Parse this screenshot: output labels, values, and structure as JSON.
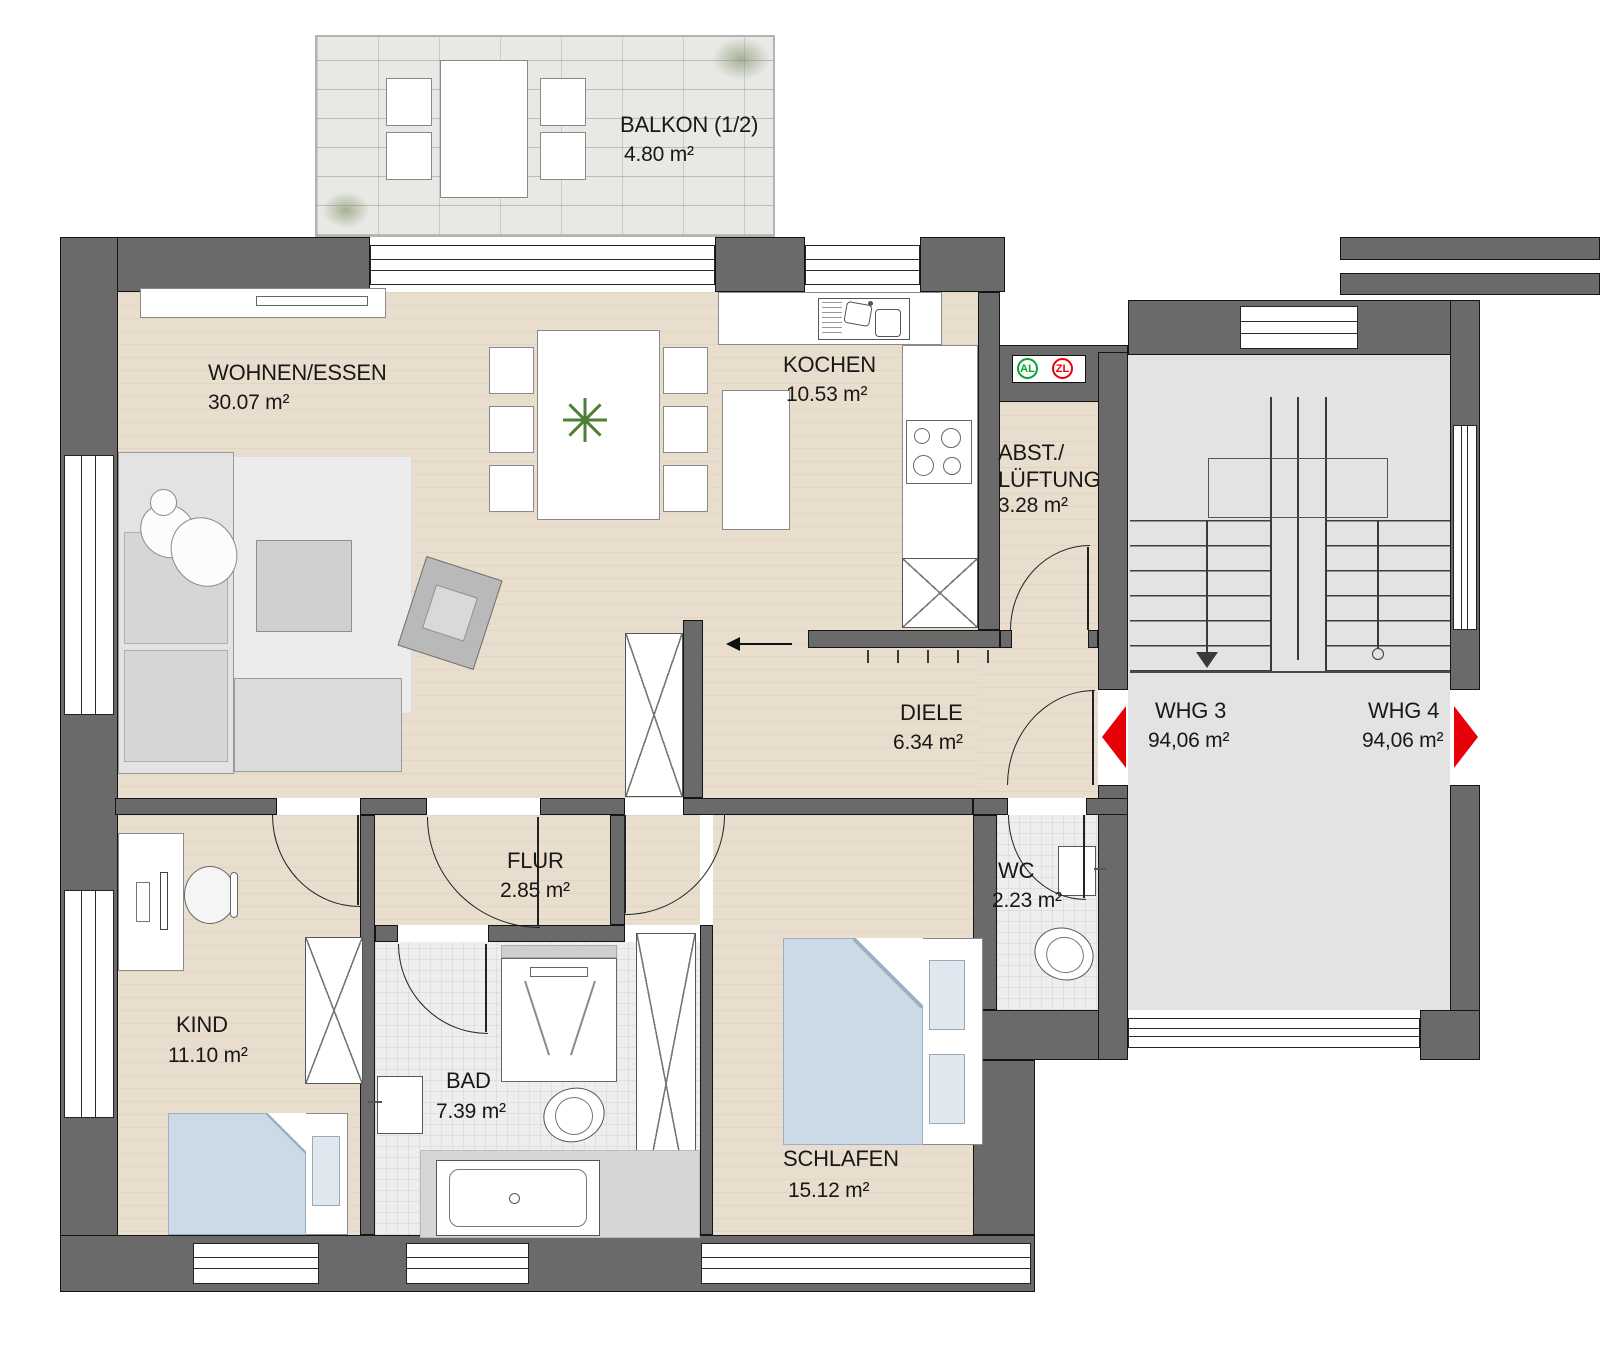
{
  "rooms": {
    "balkon": {
      "name": "BALKON (1/2)",
      "area": "4.80 m²"
    },
    "wohnen": {
      "name": "WOHNEN/ESSEN",
      "area": "30.07 m²"
    },
    "kochen": {
      "name": "KOCHEN",
      "area": "10.53 m²"
    },
    "abstellraum": {
      "line1": "ABST./",
      "line2": "LÜFTUNG",
      "area": "3.28 m²"
    },
    "diele": {
      "name": "DIELE",
      "area": "6.34 m²"
    },
    "flur": {
      "name": "FLUR",
      "area": "2.85 m²"
    },
    "wc": {
      "name": "WC",
      "area": "2.23 m²"
    },
    "kind": {
      "name": "KIND",
      "area": "11.10 m²"
    },
    "bad": {
      "name": "BAD",
      "area": "7.39 m²"
    },
    "schlafen": {
      "name": "SCHLAFEN",
      "area": "15.12 m²"
    }
  },
  "apartments": {
    "whg3": {
      "name": "WHG 3",
      "area": "94,06 m²"
    },
    "whg4": {
      "name": "WHG 4",
      "area": "94,06 m²"
    }
  },
  "vent_badges": {
    "supply": "AL",
    "exhaust": "ZL"
  },
  "symbols": {
    "whg3_entrance": "red-arrow-left",
    "whg4_entrance": "red-arrow-right",
    "stair_direction": "down-arrow",
    "entry_path": "black-arrow-left"
  },
  "colors": {
    "wall": "#6a6a6a",
    "wood_floor": "#e9decd",
    "tile_floor": "#efeeec",
    "stair_floor": "#e3e3e3",
    "balcony_stone": "#e8e8e5",
    "bed_textile": "#ccd9e6",
    "arrow_red": "#e60008",
    "badge_al_green": "#00a42e",
    "badge_zl_red": "#e60008"
  }
}
